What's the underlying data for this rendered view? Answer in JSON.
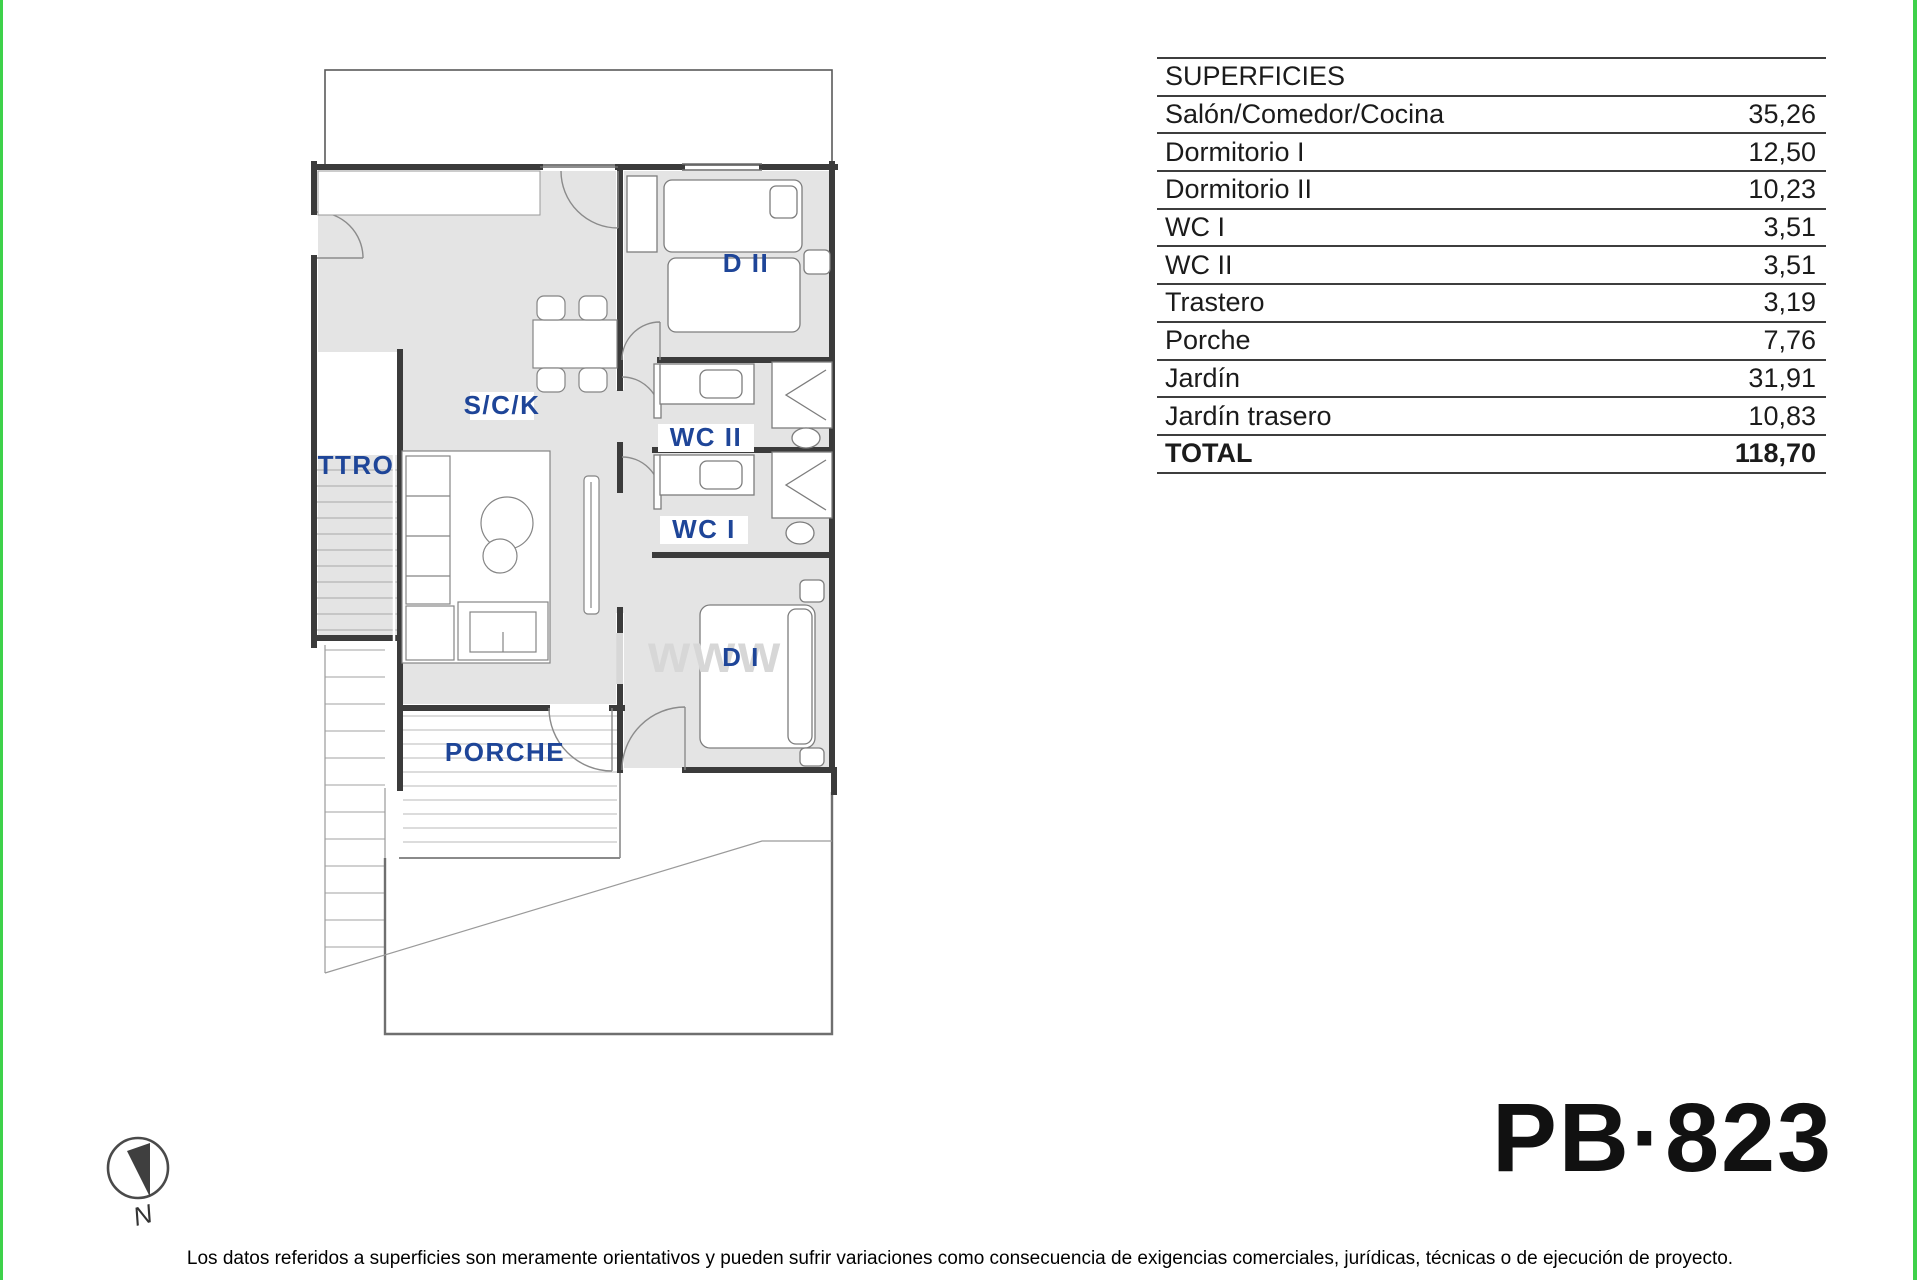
{
  "surfaces": {
    "header": "SUPERFICIES",
    "rows": [
      {
        "label": "Salón/Comedor/Cocina",
        "value": "35,26"
      },
      {
        "label": "Dormitorio I",
        "value": "12,50"
      },
      {
        "label": "Dormitorio II",
        "value": "10,23"
      },
      {
        "label": "WC I",
        "value": "3,51"
      },
      {
        "label": "WC II",
        "value": "3,51"
      },
      {
        "label": "Trastero",
        "value": "3,19"
      },
      {
        "label": "Porche",
        "value": "7,76"
      },
      {
        "label": "Jardín",
        "value": "31,91"
      },
      {
        "label": "Jardín trasero",
        "value": "10,83"
      }
    ],
    "total": {
      "label": "TOTAL",
      "value": "118,70"
    }
  },
  "plan": {
    "labels": {
      "sck": "S/C/K",
      "ttro": "TTRO",
      "wc2": "WC II",
      "wc1": "WC I",
      "d2": "D II",
      "d1": "D I",
      "porche": "PORCHE"
    },
    "watermark": "| www",
    "compass_north": "N",
    "colors": {
      "floor_gray": "#e4e4e4",
      "wall_dark": "#3b3b3b",
      "label_blue": "#1e4598",
      "edge_green": "#3ed14a"
    }
  },
  "plan_code": "PB·823",
  "disclaimer": "Los datos referidos a superficies son meramente orientativos y pueden sufrir variaciones como consecuencia de exigencias comerciales, jurídicas, técnicas o de ejecución de proyecto."
}
